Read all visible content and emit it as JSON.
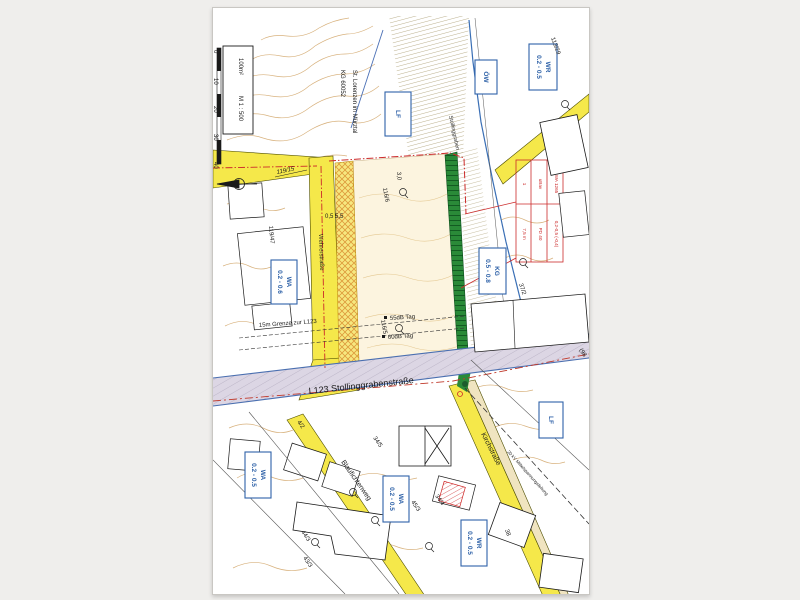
{
  "legend": {
    "area_label": "100m²",
    "scale_label": "M 1 : 500",
    "ticks": [
      "0",
      "10",
      "20",
      "30",
      "40"
    ]
  },
  "title_block": {
    "kg_line1": "KG 60052",
    "kg_line2": "St. Lorenzen im Mürztal"
  },
  "roads": {
    "l123": "L123 Stollinggrabenstraße",
    "wehrerstrasse": "Wehrerstraße",
    "kirchstrasse": "Kirchstraße",
    "blaufichtenweg": "Blaufichtenweg",
    "power_line": "20 kV Mittelspannungsleitung",
    "stream": "Stollinggraben"
  },
  "annotations": {
    "grenze": "15m Grenze zur L123",
    "db55": "55dB Tag",
    "db60": "60dB Tag",
    "dim_road": "0,5 5,5",
    "dim_green": "3,0"
  },
  "zoning_boxes": [
    {
      "l1": "WR",
      "l2": "0.2 - 0.5"
    },
    {
      "l1": "ÖW",
      "l2": ""
    },
    {
      "l1": "LF",
      "l2": ""
    },
    {
      "l1": "WA",
      "l2": "0.2 - 0.6"
    },
    {
      "l1": "WA",
      "l2": "0.2 - 0.5"
    },
    {
      "l1": "WA",
      "l2": "0.2 - 0.5"
    },
    {
      "l1": "WR",
      "l2": "0.2 - 0.5"
    },
    {
      "l1": "LF",
      "l2": ""
    },
    {
      "l1": "KG",
      "l2": "0.5 - 0.8"
    }
  ],
  "red_table": {
    "cells": [
      "1",
      "uBav",
      "WA 1265",
      "7,5 m",
      "PD 40",
      "0,2-0,5 (-0,4)"
    ]
  },
  "parcels": [
    "113/29",
    "119/15",
    "119/47",
    "116/6",
    "116/5",
    "37/2",
    "34/5",
    "4/2",
    "44/3",
    "45/3",
    "43/3",
    "34/4",
    "(98",
    "38"
  ],
  "colors": {
    "road_yellow": "#f5e84a",
    "green_strip": "#2a8a38",
    "corridor_grey": "#dcd6e4",
    "contour_brown": "#d8b27e",
    "zoning_blue": "#2f62a8",
    "plan_red": "#cc2a2a"
  }
}
